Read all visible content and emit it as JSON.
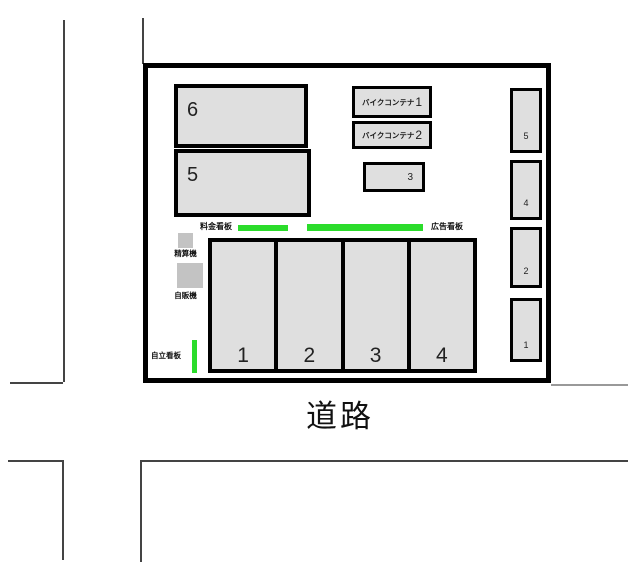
{
  "diagram": {
    "road_label": "道路",
    "site": {
      "buildings": [
        {
          "id": "6"
        },
        {
          "id": "5"
        }
      ],
      "bike_containers": [
        {
          "name": "バイクコンテナ",
          "number": "1"
        },
        {
          "name": "バイクコンテナ",
          "number": "2"
        }
      ],
      "center_spot": "3",
      "large_spots": [
        "1",
        "2",
        "3",
        "4"
      ],
      "right_spots": [
        "5",
        "4",
        "2",
        "1"
      ],
      "signs": {
        "fee_label": "料金看板",
        "ad_label": "広告看板",
        "standing_label": "自立看板"
      },
      "machines": {
        "pay_label": "精算機",
        "vending_label": "自販機"
      }
    },
    "colors": {
      "fill_gray": "#dfdfdf",
      "machine_gray": "#c3c3c3",
      "sign_green": "#2bdc2b",
      "border_black": "#000000",
      "road_line_gray": "#444444"
    }
  }
}
